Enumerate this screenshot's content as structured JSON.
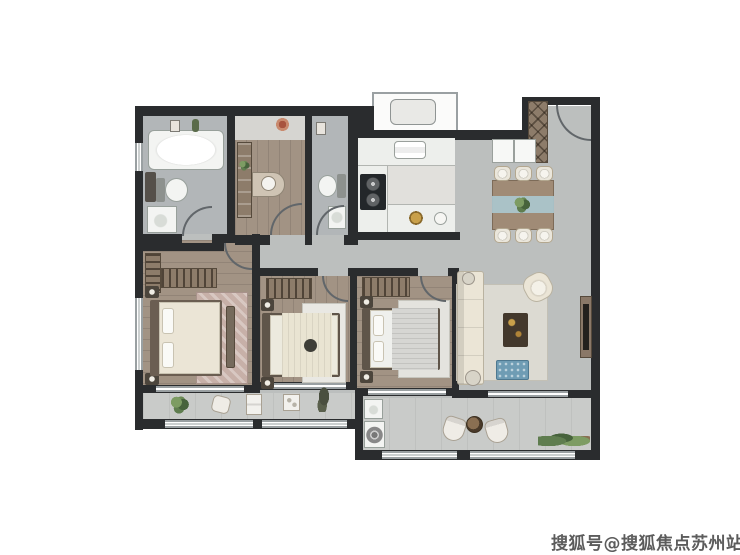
{
  "watermark": {
    "text": "搜狐号@搜狐焦点苏州站"
  },
  "palette": {
    "wall": "#2a2c2e",
    "tile": "#bcbfbe",
    "bath": "#b2b6b8",
    "kitchen": "#e1e0dc",
    "wood": "#a29384",
    "balcony": "#c9cbc9",
    "fix": "#f3f4f2",
    "cream": "#ebe5d6",
    "brown": "#8d7c6a",
    "dark": "#43382c",
    "blue": "#6f9cb4",
    "runner": "#aac7ce",
    "green": "#5f7d4f",
    "ruglight": "#dcdad2",
    "rugpink": "#c7b0a8",
    "wingray": "#9aa0a2",
    "door": "#61666a",
    "wm": "#5c5c5c"
  }
}
